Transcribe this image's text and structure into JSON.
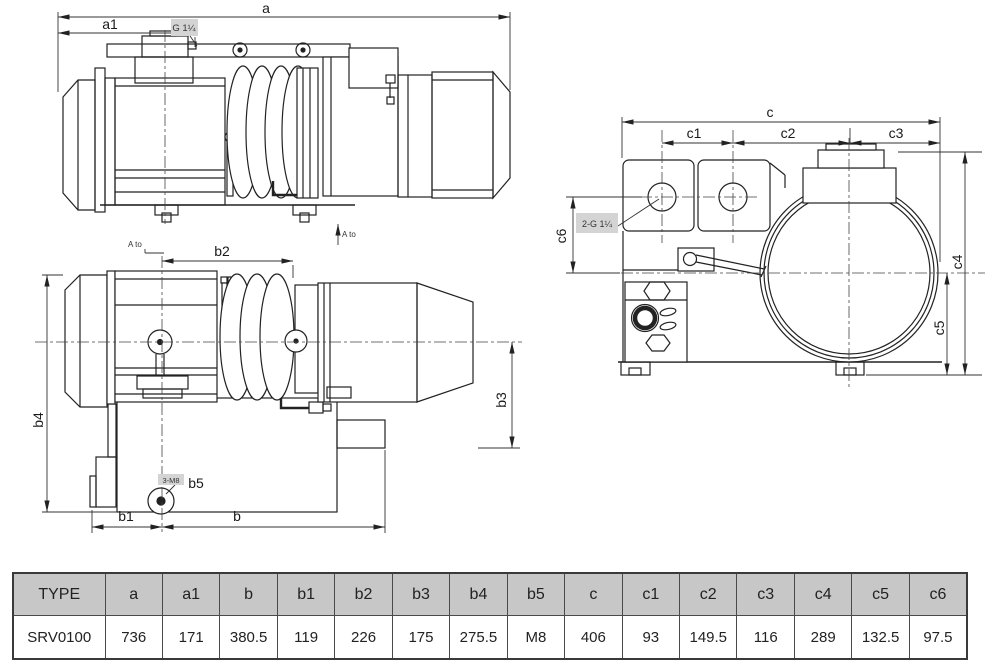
{
  "drawing": {
    "view1": {
      "dim_a": "a",
      "dim_a1": "a1",
      "port_label": "G 1¼",
      "view_label": "A to"
    },
    "view2": {
      "view_label": "A to",
      "dim_b2": "b2",
      "dim_b4": "b4",
      "dim_b3": "b3",
      "hole_label": "3-M8",
      "dim_b5": "b5",
      "dim_b1": "b1",
      "dim_b": "b"
    },
    "view3": {
      "dim_c": "c",
      "dim_c1": "c1",
      "dim_c2": "c2",
      "dim_c3": "c3",
      "ports_label": "2-G 1¼",
      "dim_c6": "c6",
      "dim_c4": "c4",
      "dim_c5": "c5"
    }
  },
  "table": {
    "headers": [
      "TYPE",
      "a",
      "a1",
      "b",
      "b1",
      "b2",
      "b3",
      "b4",
      "b5",
      "c",
      "c1",
      "c2",
      "c3",
      "c4",
      "c5",
      "c6"
    ],
    "row": [
      "SRV0100",
      "736",
      "171",
      "380.5",
      "119",
      "226",
      "175",
      "275.5",
      "M8",
      "406",
      "93",
      "149.5",
      "116",
      "289",
      "132.5",
      "97.5"
    ]
  },
  "colors": {
    "line": "#222222",
    "dim_line": "#333333",
    "table_header_bg": "#c7c7c7",
    "highlight_bg": "#d4d4d4"
  }
}
